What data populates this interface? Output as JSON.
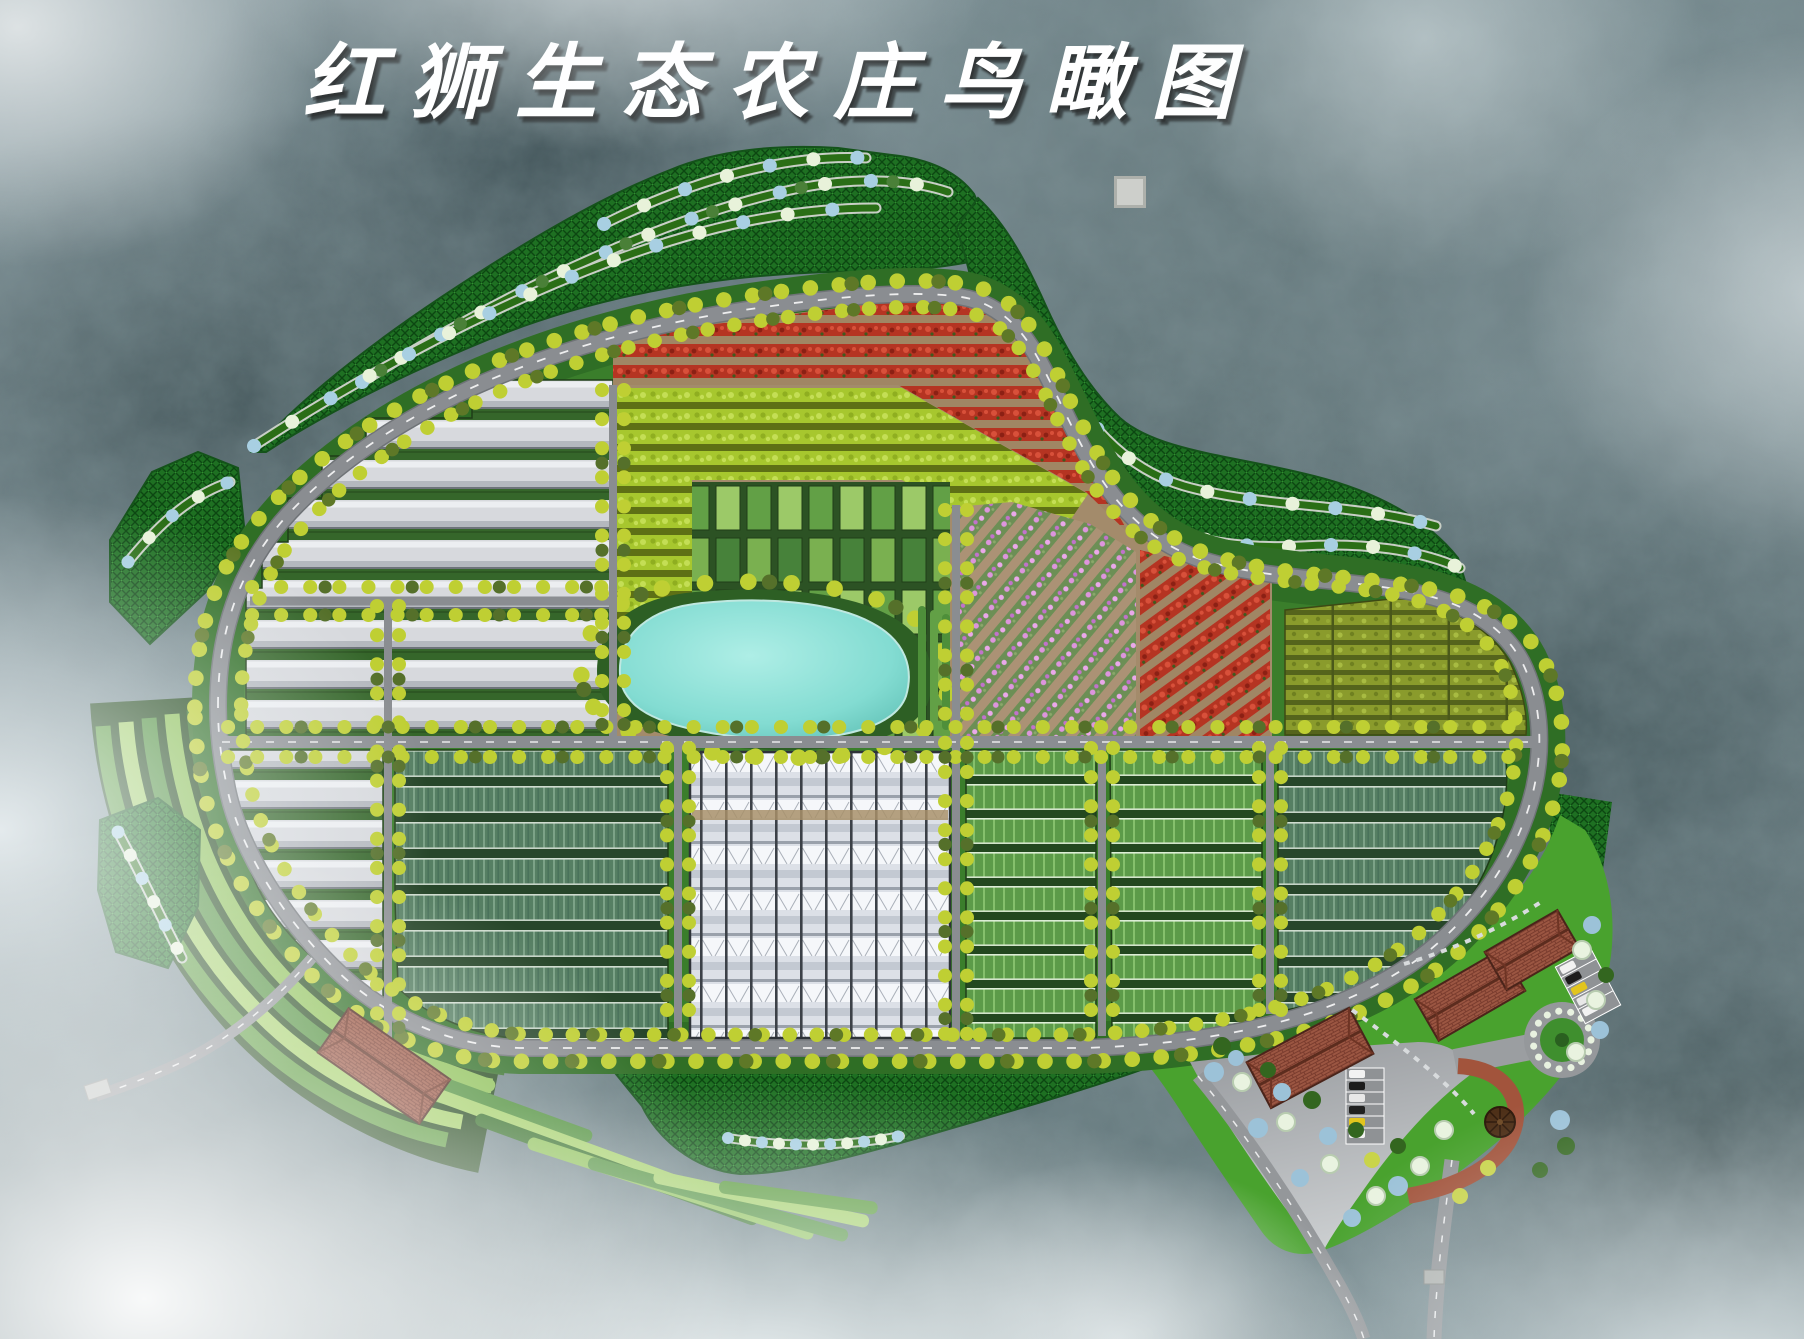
{
  "title": {
    "text": "红狮生态农庄鸟瞰图"
  },
  "scene": {
    "type": "farm-master-plan-birdseye-rendering",
    "colors": {
      "pond": "#7fd8ce",
      "road": "#85888c",
      "road_dash": "#ffffff",
      "greenhouse_tunnel": "#d7d9dd",
      "glass_greenhouse": "#e7ebf0",
      "crop_red": "#b53422",
      "crop_lime": "#a7c72e",
      "crop_pink": "#dd95dd",
      "crop_olive": "#8a9b2c",
      "crop_teal": "#567f63",
      "crop_green": "#5c9b49",
      "hill_green": "#1e7022",
      "lawn": "#49a22e",
      "soil": "#a38b6b",
      "terrace_light": "#8cc055",
      "terrace_dark": "#3f7a2c",
      "roof_brick": "#9b5642",
      "tree_yellow": "#bfcf33",
      "tree_blue": "#9cc2d8",
      "tree_pale": "#e9f3e0",
      "tree_dark": "#33661f",
      "mist": "#ffffff"
    }
  }
}
